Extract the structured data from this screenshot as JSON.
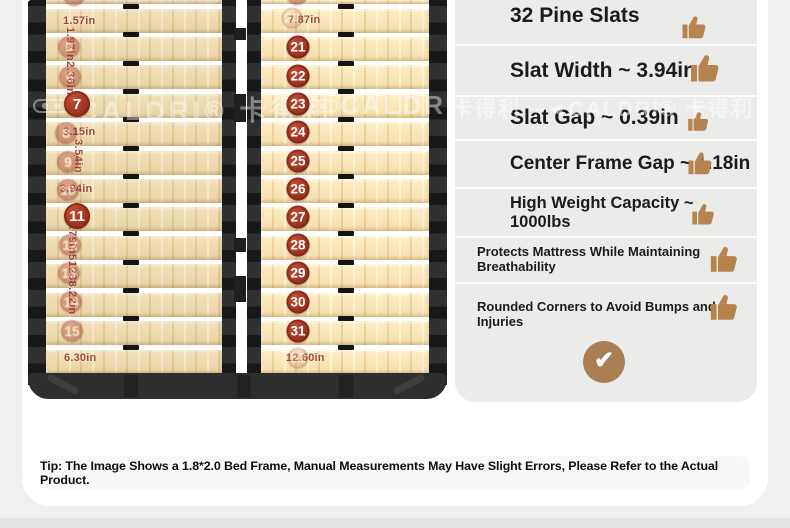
{
  "brand": {
    "name": "CALDRI",
    "reg": "®",
    "cn": "卡得利"
  },
  "watermark": {
    "seg_left": "CALDRI® 卡得利",
    "seg_mid": "CALDRI®",
    "seg_right": "卡得利 ─◄CALDRI® 卡得利"
  },
  "diagram": {
    "slat_rows": 13,
    "left_labels": [
      {
        "text": "1.57in",
        "x": 63,
        "y": 15
      },
      {
        "text": "3.15in",
        "x": 63,
        "y": 126
      },
      {
        "text": "3.94in",
        "x": 60,
        "y": 183
      },
      {
        "text": "6.30in",
        "x": 64,
        "y": 352
      }
    ],
    "left_rotated_labels": [
      {
        "text": "1.97in2.36in",
        "x": 64,
        "y": 27
      },
      {
        "text": "3.54in",
        "x": 72,
        "y": 139
      },
      {
        "text": "0.79in51238.22in",
        "x": 66,
        "y": 220
      }
    ],
    "left_solid_badges": [
      {
        "n": "7",
        "x": 77,
        "y": 104
      },
      {
        "n": "11",
        "x": 77,
        "y": 216
      }
    ],
    "left_partial_badge": {
      "n": "3",
      "x": 74,
      "y": -5
    },
    "left_faded_badges": [
      {
        "n": "5",
        "x": 69,
        "y": 47
      },
      {
        "n": "6",
        "x": 70,
        "y": 77
      },
      {
        "n": "8",
        "x": 66,
        "y": 133
      },
      {
        "n": "9",
        "x": 68,
        "y": 162
      },
      {
        "n": "10",
        "x": 68,
        "y": 190
      },
      {
        "n": "12",
        "x": 70,
        "y": 245
      },
      {
        "n": "13",
        "x": 69,
        "y": 273
      },
      {
        "n": "14",
        "x": 71,
        "y": 302
      },
      {
        "n": "15",
        "x": 72,
        "y": 331
      }
    ],
    "mid_labels": [
      {
        "text": "7.87in",
        "x": 288,
        "y": 14
      },
      {
        "text": "12.60in",
        "x": 286,
        "y": 352
      }
    ],
    "mid_solid_badges": [
      {
        "n": "21",
        "x": 298,
        "y": 47
      },
      {
        "n": "22",
        "x": 298,
        "y": 76
      },
      {
        "n": "23",
        "x": 298,
        "y": 104
      },
      {
        "n": "24",
        "x": 298,
        "y": 132
      },
      {
        "n": "25",
        "x": 298,
        "y": 161
      },
      {
        "n": "26",
        "x": 298,
        "y": 189
      },
      {
        "n": "27",
        "x": 298,
        "y": 217
      },
      {
        "n": "28",
        "x": 298,
        "y": 245
      },
      {
        "n": "29",
        "x": 298,
        "y": 273
      },
      {
        "n": "30",
        "x": 298,
        "y": 302
      },
      {
        "n": "31",
        "x": 298,
        "y": 331
      }
    ],
    "mid_partial_badge": {
      "n": "19",
      "x": 297,
      "y": -6
    },
    "mid_faded_badges": [
      {
        "n": "20",
        "x": 292,
        "y": 18
      },
      {
        "n": "32",
        "x": 298,
        "y": 358
      }
    ]
  },
  "features": {
    "rows": [
      {
        "label": "32 Pine Slats"
      },
      {
        "label": "Slat Width ~ 3.94in"
      },
      {
        "label": "Slat Gap ~ 0.39in"
      },
      {
        "label": "Center Frame Gap ~ 1.18in"
      },
      {
        "label": "High Weight Capacity ~ 1000lbs"
      },
      {
        "label": "Protects Mattress While Maintaining Breathability"
      },
      {
        "label": "Rounded Corners to Avoid Bumps and Injuries"
      }
    ],
    "icon": "thumbs-up",
    "check_icon": "check",
    "check_glyph": "✔"
  },
  "tip": {
    "text": "Tip: The Image Shows a 1.8*2.0 Bed Frame, Manual Measurements May Have Slight Errors, Please Refer to the Actual Product."
  },
  "colors": {
    "badge": "#a93c28",
    "wood": "#eedaae",
    "frame": "#2d2d2d",
    "panel_bg": "#ebebea",
    "icon_tan": "#b5854f",
    "check_bg": "#a87e52",
    "label": "#a14a36",
    "page_bg": "#eff1ef"
  }
}
